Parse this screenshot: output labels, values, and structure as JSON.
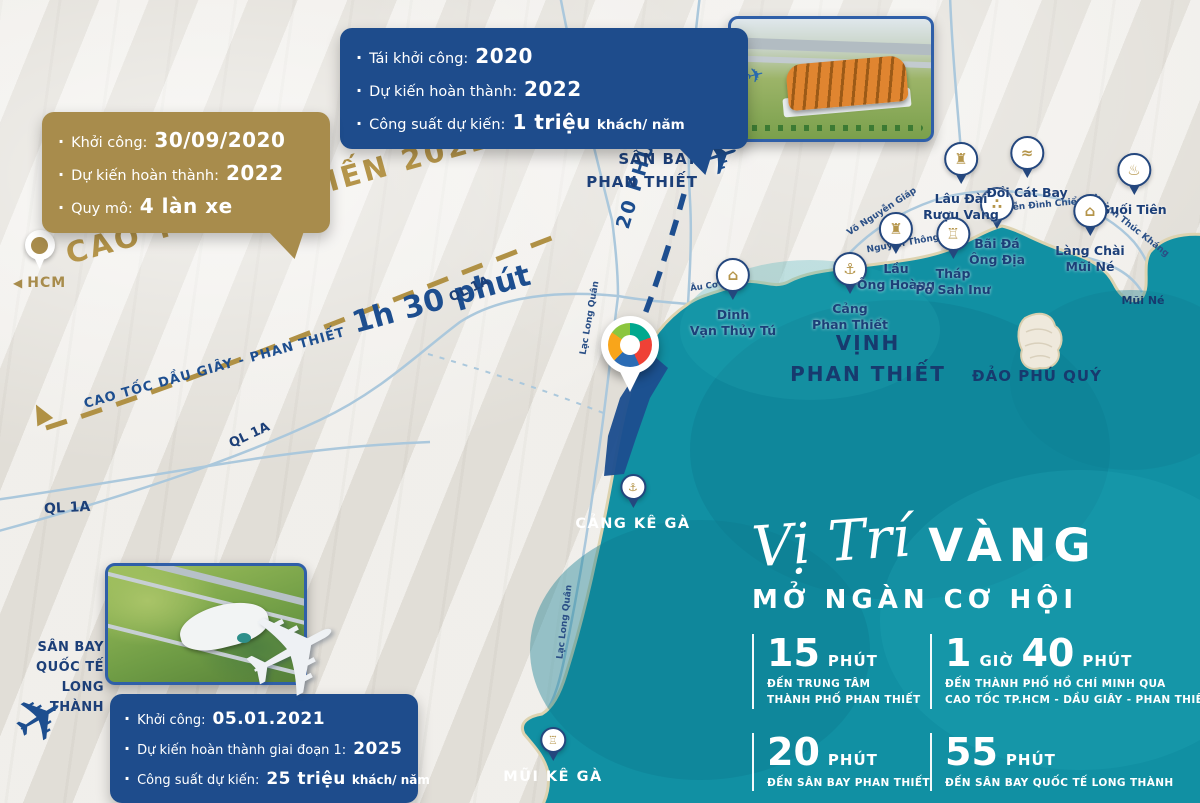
{
  "colors": {
    "navy": "#1e4c8c",
    "gold": "#a88c4c",
    "sea": "#1190a3",
    "text_navy": "#1c3f78",
    "white": "#ffffff"
  },
  "callouts": {
    "pt_airport": {
      "items": [
        {
          "label": "Tái khởi công:",
          "value": "2020",
          "suffix": ""
        },
        {
          "label": "Dự kiến hoàn thành:",
          "value": "2022",
          "suffix": ""
        },
        {
          "label": "Công suất dự kiến:",
          "value": "1 triệu",
          "suffix": "khách/ năm"
        }
      ]
    },
    "expressway": {
      "items": [
        {
          "label": "Khởi công:",
          "value": "30/09/2020",
          "suffix": ""
        },
        {
          "label": "Dự kiến hoàn thành:",
          "value": "2022",
          "suffix": ""
        },
        {
          "label": "Quy mô:",
          "value": "4 làn xe",
          "suffix": ""
        }
      ]
    },
    "long_thanh": {
      "items": [
        {
          "label": "Khởi công:",
          "value": "05.01.2021",
          "suffix": ""
        },
        {
          "label": "Dự kiến hoàn thành giai đoạn 1:",
          "value": "2025",
          "suffix": ""
        },
        {
          "label": "Công suất dự kiến:",
          "value": "25 triệu",
          "suffix": "khách/ năm"
        }
      ]
    }
  },
  "labels": {
    "san_bay_phan_thiet": {
      "l1": "SÂN BAY",
      "l2": "PHAN THIẾT"
    },
    "long_thanh": {
      "l1": "SÂN BAY",
      "l2": "QUỐC TẾ",
      "l3": "LONG THÀNH"
    }
  },
  "routes": {
    "cao_toc_label": "CAO TỐC DỰ KIẾN 2022",
    "cao_toc_detail": "CAO TỐC DẦU GIÂY - PHAN THIẾT",
    "cao_toc_time": "1h 30 phút",
    "airport_time": "20 PHÚT",
    "hcm": "HCM"
  },
  "roads": {
    "ql1a": "QL 1A",
    "lac_long_quan": "Lạc Long Quân",
    "au_co": "Âu Cơ",
    "nguyen_thong": "Nguyễn Thông",
    "vo_nguyen_giap": "Võ Nguyễn Giáp",
    "nguyen_dinh_chieu": "Nguyễn Đình Chiểu",
    "huynh_thuc_khang": "Huỳnh Thúc Kháng"
  },
  "markers": [
    {
      "id": "dinh-van-thuy-tu",
      "l1": "Dinh",
      "l2": "Vạn Thủy Tú",
      "icon": "temple-icon",
      "glyph": "⌂"
    },
    {
      "id": "cang-phan-thiet",
      "l1": "Cảng",
      "l2": "Phan Thiết",
      "icon": "port-icon",
      "glyph": "⚓"
    },
    {
      "id": "lau-ong-hoang",
      "l1": "Lầu",
      "l2": "Ông Hoàng",
      "icon": "tower-icon",
      "glyph": "♜"
    },
    {
      "id": "thap-po-sah-inu",
      "l1": "Tháp",
      "l2": "Po Sah Inư",
      "icon": "cham-tower-icon",
      "glyph": "♖"
    },
    {
      "id": "bai-da-ong-dia",
      "l1": "Bãi Đá",
      "l2": "Ông Địa",
      "icon": "rocks-icon",
      "glyph": "∴"
    },
    {
      "id": "lau-dai-ruou-vang",
      "l1": "Lâu Đài",
      "l2": "Rượu Vang",
      "icon": "castle-icon",
      "glyph": "♜"
    },
    {
      "id": "doi-cat-bay",
      "l1": "Đồi Cát Bay",
      "l2": "",
      "icon": "sand-dune-icon",
      "glyph": "≈"
    },
    {
      "id": "suoi-tien",
      "l1": "Suối Tiên",
      "l2": "",
      "icon": "stream-icon",
      "glyph": "♨"
    },
    {
      "id": "lang-chai-mui-ne",
      "l1": "Làng Chài",
      "l2": "Mũi Né",
      "icon": "fishing-village-icon",
      "glyph": "⌂"
    },
    {
      "id": "cang-ke-ga",
      "l1": "CẢNG KÊ GÀ",
      "l2": "",
      "icon": "port-icon",
      "glyph": "⚓"
    },
    {
      "id": "mui-ke-ga",
      "l1": "MŨI KÊ GÀ",
      "l2": "",
      "icon": "lighthouse-icon",
      "glyph": "♖"
    }
  ],
  "sea": {
    "bay_l1": "VỊNH",
    "bay_l2": "PHAN THIẾT",
    "island": "ĐẢO PHÚ QUÝ",
    "cape": "Mũi Né"
  },
  "headline": {
    "script": "Vị Trí",
    "emphasis": "VÀNG",
    "line2": "MỞ NGÀN CƠ HỘI"
  },
  "stats": [
    {
      "v1": "15",
      "u1": "PHÚT",
      "d1": "ĐẾN TRUNG TÂM",
      "d2": "THÀNH PHỐ PHAN THIẾT"
    },
    {
      "v1": "1",
      "u1": "GIỜ",
      "v2": "40",
      "u2": "PHÚT",
      "d1": "ĐẾN THÀNH PHỐ HỒ CHÍ MINH QUA",
      "d2": "CAO TỐC TP.HCM - DẦU GIÂY - PHAN THIẾT"
    },
    {
      "v1": "20",
      "u1": "PHÚT",
      "d1": "ĐẾN SÂN BAY PHAN THIẾT",
      "d2": ""
    },
    {
      "v1": "55",
      "u1": "PHÚT",
      "d1": "ĐẾN SÂN BAY QUỐC TẾ LONG THÀNH",
      "d2": ""
    }
  ],
  "icons": {
    "plane": "✈"
  }
}
